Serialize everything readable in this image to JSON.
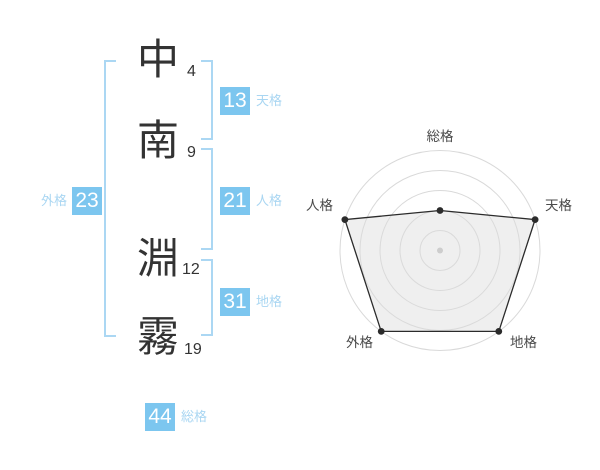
{
  "name_panel": {
    "characters": [
      {
        "char": "中",
        "strokes": "4"
      },
      {
        "char": "南",
        "strokes": "9"
      },
      {
        "char": "淵",
        "strokes": "12"
      },
      {
        "char": "霧",
        "strokes": "19"
      }
    ],
    "badges": {
      "tenkaku": {
        "value": "13",
        "label": "天格"
      },
      "jinkaku": {
        "value": "21",
        "label": "人格"
      },
      "chikaku": {
        "value": "31",
        "label": "地格"
      },
      "gaikaku": {
        "value": "23",
        "label": "外格"
      },
      "soukaku": {
        "value": "44",
        "label": "総格"
      }
    },
    "colors": {
      "badge_bg": "#7cc6ef",
      "badge_text": "#ffffff",
      "label_text": "#a9d6f2",
      "bracket": "#abd7f3",
      "kanji_text": "#333333"
    }
  },
  "chart_data": {
    "type": "radar",
    "title": "",
    "categories": [
      "総格",
      "天格",
      "地格",
      "外格",
      "人格"
    ],
    "values": [
      2,
      5,
      5,
      5,
      5
    ],
    "max": 5,
    "rings": 5,
    "start_angle_deg": 90,
    "direction": "clockwise",
    "grid": "concentric-circles",
    "legend": "none",
    "colors": {
      "ring": "#d9d9d9",
      "polygon_fill": "#dcdcdc",
      "polygon_fill_opacity": "0.45",
      "polygon_stroke": "#2b2b2b",
      "point": "#2b2b2b",
      "center_dot": "#c2c2c2",
      "label": "#4a4a4a"
    }
  }
}
